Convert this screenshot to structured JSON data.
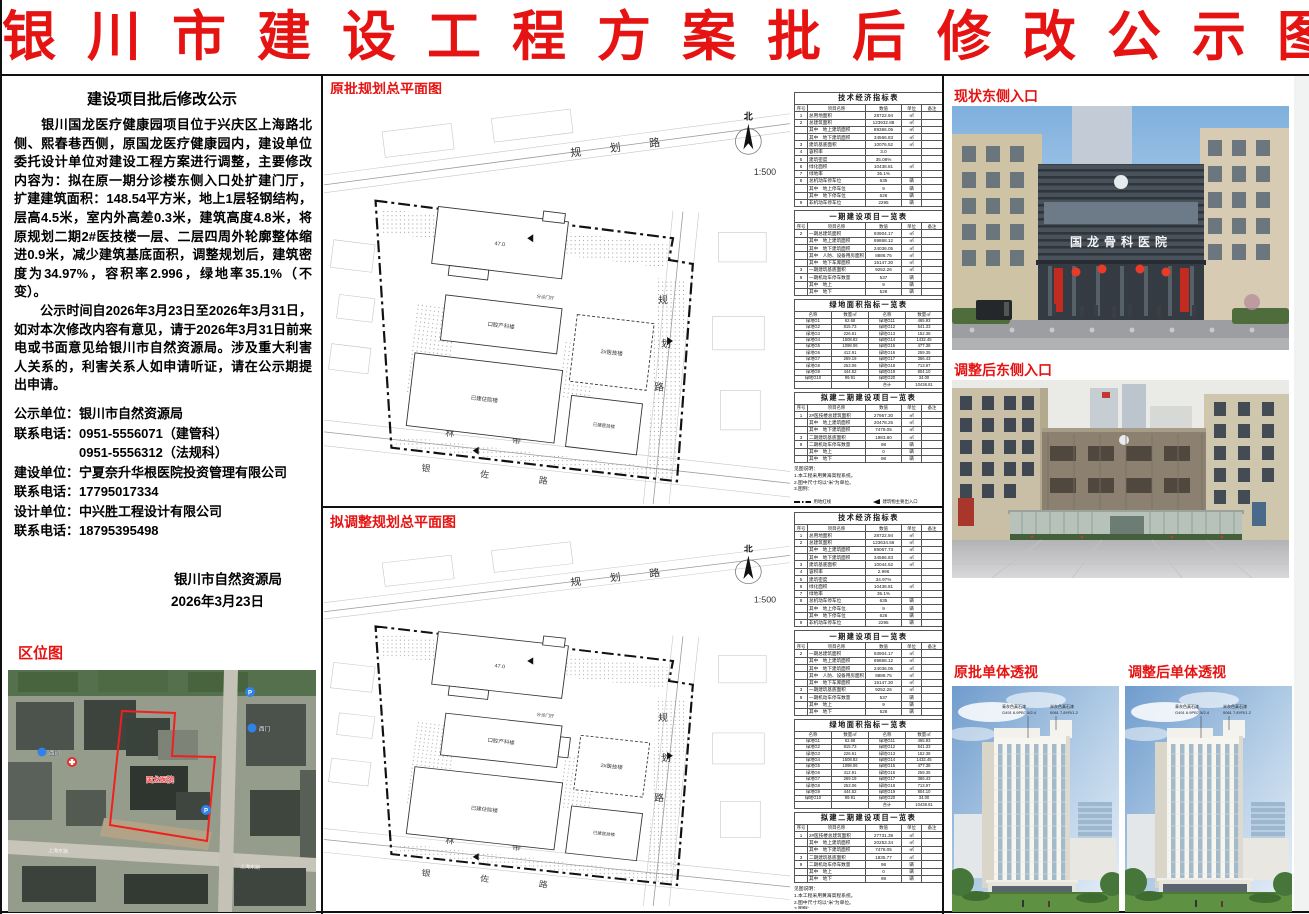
{
  "title": "银川市建设工程方案批后修改公示图",
  "notice": {
    "heading": "建设项目批后修改公示",
    "para1": "　　银川国龙医疗健康园项目位于兴庆区上海路北侧、熙春巷西侧，原国龙医疗健康园内，建设单位委托设计单位对建设工程方案进行调整，主要修改内容为：拟在原一期分诊楼东侧入口处扩建门厅，扩建建筑面积：148.54平方米，地上1层轻钢结构，层高4.5米，室内外高差0.3米，建筑高度4.8米，将原规划二期2#医技楼一层、二层四周外轮廓整体缩进0.9米，减少建筑基底面积，调整规划后，建筑密度为34.97%，容积率2.996，绿地率35.1%（不变）。",
    "para2": "　　公示时间自2026年3月23日至2026年3月31日，如对本次修改内容有意见，请于2026年3月31日前来电或书面意见给银川市自然资源局。涉及重大利害人关系的，利害关系人如申请听证，请在公示期提出申请。",
    "contacts": [
      "公示单位：银川市自然资源局",
      "联系电话：0951-5556071（建管科）",
      "　　　　　0951-5556312（法规科）",
      "建设单位：宁夏奈升华根医院投资管理有限公司",
      "联系电话：17795017334",
      "设计单位：中兴胜工程设计有限公司",
      "联系电话：18795395498"
    ],
    "authority": "银川市自然资源局",
    "date": "2026年3月23日"
  },
  "location_map": {
    "label": "区位图",
    "site": "国龙医院",
    "gate1": "西门",
    "gate2": "西门",
    "road1": "上海东路",
    "road2": "上海东路",
    "p": "P"
  },
  "plans": {
    "orig": {
      "label": "原批规划总平面图",
      "north": "北",
      "scale": "1:500",
      "road_top": "规 划 路",
      "rr": [
        "规",
        "划",
        "路"
      ],
      "green_belt": "林 带",
      "road_bottom": "银 佐 路",
      "b_top": "47.0",
      "b_mid": "口腔产科楼",
      "b_phase2": "2#医技楼",
      "b_low": "已建住院楼",
      "b_low_r": "已建医技楼",
      "b_hall": "分诊门厅"
    },
    "adj": {
      "label": "拟调整规划总平面图",
      "north": "北",
      "scale": "1:500",
      "road_top": "规 划 路",
      "rr": [
        "规",
        "划",
        "路"
      ],
      "green_belt": "林 带",
      "road_bottom": "银 佐 路",
      "b_top": "47.0",
      "b_mid": "口腔产科楼",
      "b_phase2": "2#医技楼",
      "b_low": "已建住院楼",
      "b_low_r": "已建医技楼",
      "b_hall": "分诊门厅"
    }
  },
  "tables": {
    "cols": [
      "序号",
      "项目名称",
      "数值",
      "单位",
      "备注"
    ],
    "green_cols": [
      "名称",
      "数量㎡",
      "名称",
      "数量㎡"
    ],
    "notes": [
      "见图说明：",
      "1.本工程采用黄海高程系统。",
      "2.图中尺寸均以“米”为单位。",
      "3.图例："
    ],
    "legend": [
      {
        "sym": "dashdot",
        "label": "用地红线"
      },
      {
        "sym": "tri",
        "label": "建筑物主要出入口"
      },
      {
        "sym": "dashed",
        "label": "地下车库范围线"
      },
      {
        "sym": "inbox",
        "label": "地下汽车库入口"
      },
      {
        "sym": "pbox",
        "label": "机动车停车位"
      },
      {
        "sym": "dotbox",
        "label": "绿化用地"
      },
      {
        "sym": "gate",
        "label": "场地出入口"
      },
      {
        "sym": "crossbox",
        "label": "消防登高面"
      }
    ],
    "orig": {
      "indicator": {
        "title": "技术经济指标表",
        "rows": [
          [
            "1",
            "总用地面积",
            "28722.94",
            "㎡",
            ""
          ],
          [
            "2",
            "总建筑面积",
            "123932.88",
            "㎡",
            ""
          ],
          [
            "",
            "其中　地上建筑面积",
            "89366.05",
            "㎡",
            ""
          ],
          [
            "",
            "其中　地下建筑面积",
            "34566.83",
            "㎡",
            ""
          ],
          [
            "3",
            "建筑基底面积",
            "10076.52",
            "㎡",
            ""
          ],
          [
            "4",
            "容积率",
            "3.0",
            "",
            ""
          ],
          [
            "5",
            "建筑密度",
            "35.08%",
            "",
            ""
          ],
          [
            "6",
            "绿化面积",
            "10438.81",
            "㎡",
            ""
          ],
          [
            "7",
            "绿地率",
            "35.1%",
            "",
            ""
          ],
          [
            "8",
            "总机动车停车位",
            "635",
            "辆",
            ""
          ],
          [
            "",
            "其中　地上停车位",
            "9",
            "辆",
            ""
          ],
          [
            "",
            "其中　地下停车位",
            "626",
            "辆",
            ""
          ],
          [
            "9",
            "非机动车停车位",
            "2295",
            "辆",
            ""
          ]
        ]
      },
      "phase1": {
        "title": "一期建设项目一览表",
        "rows": [
          [
            "2",
            "一期总建筑面积",
            "93904.17",
            "㎡",
            ""
          ],
          [
            "",
            "其中　地上建筑面积",
            "69868.12",
            "㎡",
            ""
          ],
          [
            "",
            "其中　地下建筑面积",
            "24036.05",
            "㎡",
            ""
          ],
          [
            "",
            "其中　人防、设备用房面积",
            "8888.75",
            "㎡",
            ""
          ],
          [
            "",
            "其中　地下车库面积",
            "15147.30",
            "㎡",
            ""
          ],
          [
            "3",
            "一期建筑基底面积",
            "9252.26",
            "㎡",
            ""
          ],
          [
            "9",
            "一期机动车停车数量",
            "537",
            "辆",
            ""
          ],
          [
            "",
            "其中　地上",
            "9",
            "辆",
            ""
          ],
          [
            "",
            "其中　地下",
            "528",
            "辆",
            ""
          ]
        ]
      },
      "green": {
        "title": "绿地面积指标一览表",
        "rows": [
          [
            "绿地G1",
            "62.68",
            "绿地G11",
            "465.93"
          ],
          [
            "绿地G2",
            "815.73",
            "绿地G12",
            "541.33"
          ],
          [
            "绿地G3",
            "226.61",
            "绿地G13",
            "152.38"
          ],
          [
            "绿地G4",
            "1508.82",
            "绿地G14",
            "1432.45"
          ],
          [
            "绿地G5",
            "1098.06",
            "绿地G15",
            "477.38"
          ],
          [
            "绿地G6",
            "412.91",
            "绿地G16",
            "259.35"
          ],
          [
            "绿地G7",
            "269.19",
            "绿地G17",
            "366.43"
          ],
          [
            "绿地G8",
            "253.06",
            "绿地G18",
            "713.97"
          ],
          [
            "绿地G9",
            "444.52",
            "绿地G19",
            "804.10"
          ],
          [
            "绿地G10",
            "99.91",
            "绿地G20",
            "34.00"
          ],
          [
            "",
            "",
            "合计",
            "10438.81"
          ]
        ]
      },
      "phase2": {
        "title": "拟建二期建设项目一览表",
        "rows": [
          [
            "1",
            "2#医技楼总建筑面积",
            "27957.30",
            "㎡",
            ""
          ],
          [
            "",
            "其中　地上建筑面积",
            "20478.25",
            "㎡",
            ""
          ],
          [
            "",
            "其中　地下建筑面积",
            "7479.05",
            "㎡",
            ""
          ],
          [
            "3",
            "二期建筑基底面积",
            "1983.80",
            "㎡",
            ""
          ],
          [
            "9",
            "二期机动车停车数量",
            "98",
            "辆",
            ""
          ],
          [
            "",
            "其中　地上",
            "0",
            "辆",
            ""
          ],
          [
            "",
            "其中　地下",
            "98",
            "辆",
            ""
          ]
        ]
      }
    },
    "adj": {
      "indicator": {
        "title": "技术经济指标表",
        "rows": [
          [
            "1",
            "总用地面积",
            "28722.94",
            "㎡",
            ""
          ],
          [
            "2",
            "总建筑面积",
            "123634.56",
            "㎡",
            ""
          ],
          [
            "",
            "其中　地上建筑面积",
            "89067.73",
            "㎡",
            ""
          ],
          [
            "",
            "其中　地下建筑面积",
            "34566.83",
            "㎡",
            ""
          ],
          [
            "3",
            "建筑基底面积",
            "10044.52",
            "㎡",
            ""
          ],
          [
            "4",
            "容积率",
            "2.996",
            "",
            ""
          ],
          [
            "5",
            "建筑密度",
            "34.97%",
            "",
            ""
          ],
          [
            "6",
            "绿化面积",
            "10438.81",
            "㎡",
            ""
          ],
          [
            "7",
            "绿地率",
            "35.1%",
            "",
            ""
          ],
          [
            "8",
            "总机动车停车位",
            "635",
            "辆",
            ""
          ],
          [
            "",
            "其中　地上停车位",
            "9",
            "辆",
            ""
          ],
          [
            "",
            "其中　地下停车位",
            "626",
            "辆",
            ""
          ],
          [
            "9",
            "非机动车停车位",
            "2295",
            "辆",
            ""
          ]
        ]
      },
      "phase1": {
        "title": "一期建设项目一览表",
        "rows": [
          [
            "2",
            "一期总建筑面积",
            "93904.17",
            "㎡",
            ""
          ],
          [
            "",
            "其中　地上建筑面积",
            "69868.12",
            "㎡",
            ""
          ],
          [
            "",
            "其中　地下建筑面积",
            "24036.05",
            "㎡",
            ""
          ],
          [
            "",
            "其中　人防、设备用房面积",
            "8888.75",
            "㎡",
            ""
          ],
          [
            "",
            "其中　地下车库面积",
            "15147.30",
            "㎡",
            ""
          ],
          [
            "3",
            "一期建筑基底面积",
            "9252.26",
            "㎡",
            ""
          ],
          [
            "9",
            "一期机动车停车数量",
            "537",
            "辆",
            ""
          ],
          [
            "",
            "其中　地上",
            "9",
            "辆",
            ""
          ],
          [
            "",
            "其中　地下",
            "528",
            "辆",
            ""
          ]
        ]
      },
      "green": {
        "title": "绿地面积指标一览表",
        "rows": [
          [
            "绿地G1",
            "62.68",
            "绿地G11",
            "465.93"
          ],
          [
            "绿地G2",
            "815.73",
            "绿地G12",
            "541.33"
          ],
          [
            "绿地G3",
            "226.61",
            "绿地G13",
            "152.38"
          ],
          [
            "绿地G4",
            "1508.82",
            "绿地G14",
            "1432.45"
          ],
          [
            "绿地G5",
            "1098.06",
            "绿地G15",
            "477.38"
          ],
          [
            "绿地G6",
            "412.91",
            "绿地G16",
            "259.35"
          ],
          [
            "绿地G7",
            "269.19",
            "绿地G17",
            "366.43"
          ],
          [
            "绿地G8",
            "253.06",
            "绿地G18",
            "713.97"
          ],
          [
            "绿地G9",
            "444.52",
            "绿地G19",
            "804.10"
          ],
          [
            "绿地G10",
            "99.91",
            "绿地G20",
            "34.00"
          ],
          [
            "",
            "",
            "合计",
            "10438.81"
          ]
        ]
      },
      "phase2": {
        "title": "拟建二期建设项目一览表",
        "rows": [
          [
            "1",
            "2#医技楼总建筑面积",
            "27731.39",
            "㎡",
            ""
          ],
          [
            "",
            "其中　地上建筑面积",
            "20253.34",
            "㎡",
            ""
          ],
          [
            "",
            "其中　地下建筑面积",
            "7478.05",
            "㎡",
            ""
          ],
          [
            "3",
            "二期建筑基底面积",
            "1835.77",
            "㎡",
            ""
          ],
          [
            "9",
            "二期机动车停车数量",
            "98",
            "辆",
            ""
          ],
          [
            "",
            "其中　地上",
            "0",
            "辆",
            ""
          ],
          [
            "",
            "其中　地下",
            "98",
            "辆",
            ""
          ]
        ]
      }
    }
  },
  "photos": {
    "p1": {
      "label": "现状东侧入口",
      "sign": "国龙骨科医院"
    },
    "p2": {
      "label": "调整后东侧入口"
    }
  },
  "renders": {
    "r1": {
      "label": "原批单体透视"
    },
    "r2": {
      "label": "调整后单体透视"
    },
    "ann1": "青灰色真石漆",
    "ann1b": "G491 6.9PB7.5/2.4",
    "ann2": "米灰色真石漆",
    "ann2b": "0061 7.8YR/1.2"
  }
}
